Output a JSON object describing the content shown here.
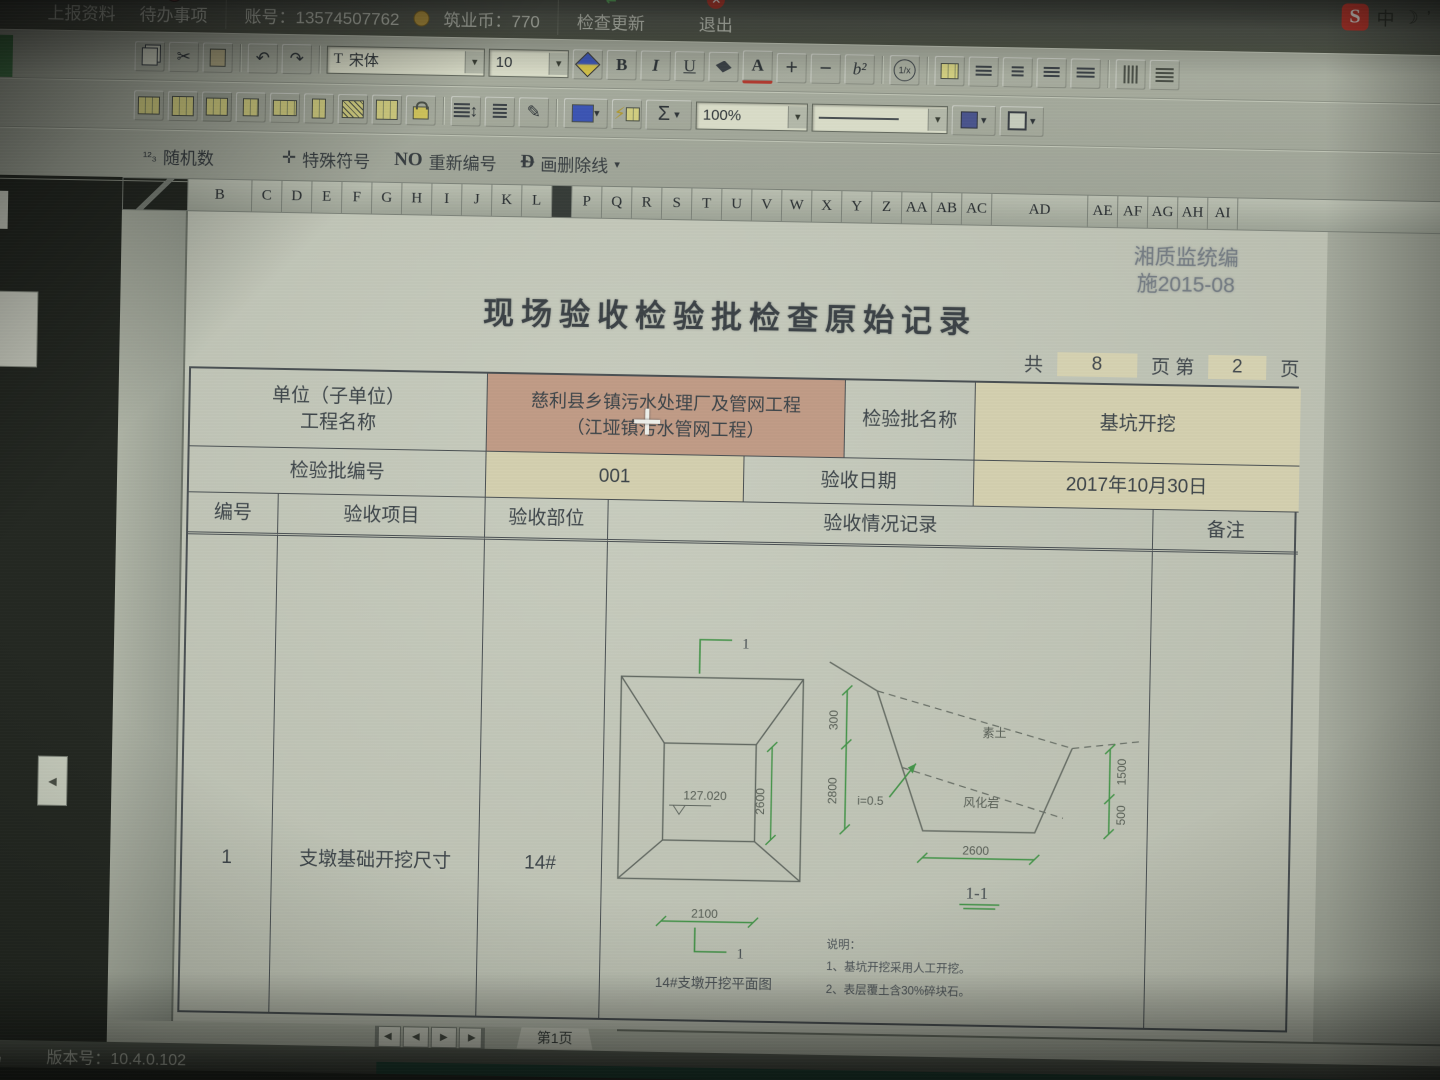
{
  "ime_bar": {
    "logo": "S",
    "mode": "中",
    "moon": "☽",
    "punct": "’",
    "keyboard": "▦"
  },
  "top_menu": {
    "upload": "上报资料",
    "todo": "待办事项",
    "account": "账号：13574507762",
    "coins": "筑业币：770",
    "update": "检查更新",
    "exit": "退出",
    "exit_glyph": "✕",
    "update_glyph": "⇄",
    "upload_glyph": "▲"
  },
  "toolbar": {
    "font_name": "宋体",
    "font_size": "10",
    "zoom": "100%",
    "bold": "B",
    "italic": "I",
    "underline": "U",
    "font_color": "A",
    "plus": "+",
    "minus": "−",
    "superscript": "b²",
    "fraction": "1/x",
    "sum": "Σ",
    "undo": "↶",
    "redo": "↷",
    "cut": "✂",
    "font_tag": "T",
    "random_glyph": "¹²₃",
    "random": "随机数",
    "special_glyph": "✛",
    "special": "特殊符号",
    "renumber_prefix": "NO",
    "renumber": "重新编号",
    "strike_prefix": "Ð",
    "strike": "画删除线",
    "caret": "▾"
  },
  "grid": {
    "columns": [
      "B",
      "C",
      "D",
      "E",
      "F",
      "G",
      "H",
      "I",
      "J",
      "K",
      "L",
      "",
      "P",
      "Q",
      "R",
      "S",
      "T",
      "U",
      "V",
      "W",
      "X",
      "Y",
      "Z",
      "AA",
      "AB",
      "AC",
      "AD",
      "AE",
      "AF",
      "AG",
      "AH",
      "AI"
    ],
    "rows": [
      "2",
      "3",
      "4",
      "5",
      "6",
      "7",
      "8",
      "9",
      "10",
      "11",
      "12",
      "13",
      "14",
      "15",
      "16"
    ]
  },
  "document": {
    "stamp_line1": "湘质监统编",
    "stamp_line2": "施2015-08",
    "title": "现场验收检验批检查原始记录",
    "pagination": {
      "total_prefix": "共",
      "total": "8",
      "middle": "页 第",
      "page": "2",
      "suffix": "页"
    },
    "info": {
      "unit_label_1": "单位（子单位）",
      "unit_label_2": "工程名称",
      "unit_value_1": "慈利县乡镇污水处理厂及管网工程",
      "unit_value_2": "（江垭镇污水管网工程）",
      "batch_label": "检验批名称",
      "batch_value": "基坑开挖",
      "no_label": "检验批编号",
      "no_value": "001",
      "date_label": "验收日期",
      "date_value": "2017年10月30日"
    },
    "record": {
      "headers": [
        "编号",
        "验收项目",
        "验收部位",
        "验收情况记录",
        "备注"
      ],
      "row_no": "1",
      "row_item": "支墩基础开挖尺寸",
      "row_part": "14#"
    },
    "plan": {
      "mark_top": "1",
      "mark_bottom": "1",
      "elev": "127.020",
      "dim_v": "2600",
      "dim_h": "2100",
      "caption": "14#支墩开挖平面图"
    },
    "section": {
      "dim_300": "300",
      "dim_2800": "2800",
      "slope": "i=0.5",
      "soil_top": "素土",
      "soil_bottom": "风化岩",
      "dim_1500": "1500",
      "dim_500": "500",
      "dim_2600": "2600",
      "label": "1-1"
    },
    "notes": [
      "说明：",
      "1、基坑开挖采用人工开挖。",
      "2、表层覆土含30%碎块石。"
    ]
  },
  "tabs": {
    "first": "◀",
    "prev": "◀",
    "next": "▶",
    "last": "▶",
    "sheet": "第1页"
  },
  "status": {
    "left": "易",
    "version": "版本号：10.4.0.102"
  },
  "colors": {
    "salmon": "#c89d85",
    "cream": "#d8d3ae",
    "dim_green": "#3f9a44",
    "exit_red": "#c0392b",
    "ime_red": "#d8372a"
  }
}
